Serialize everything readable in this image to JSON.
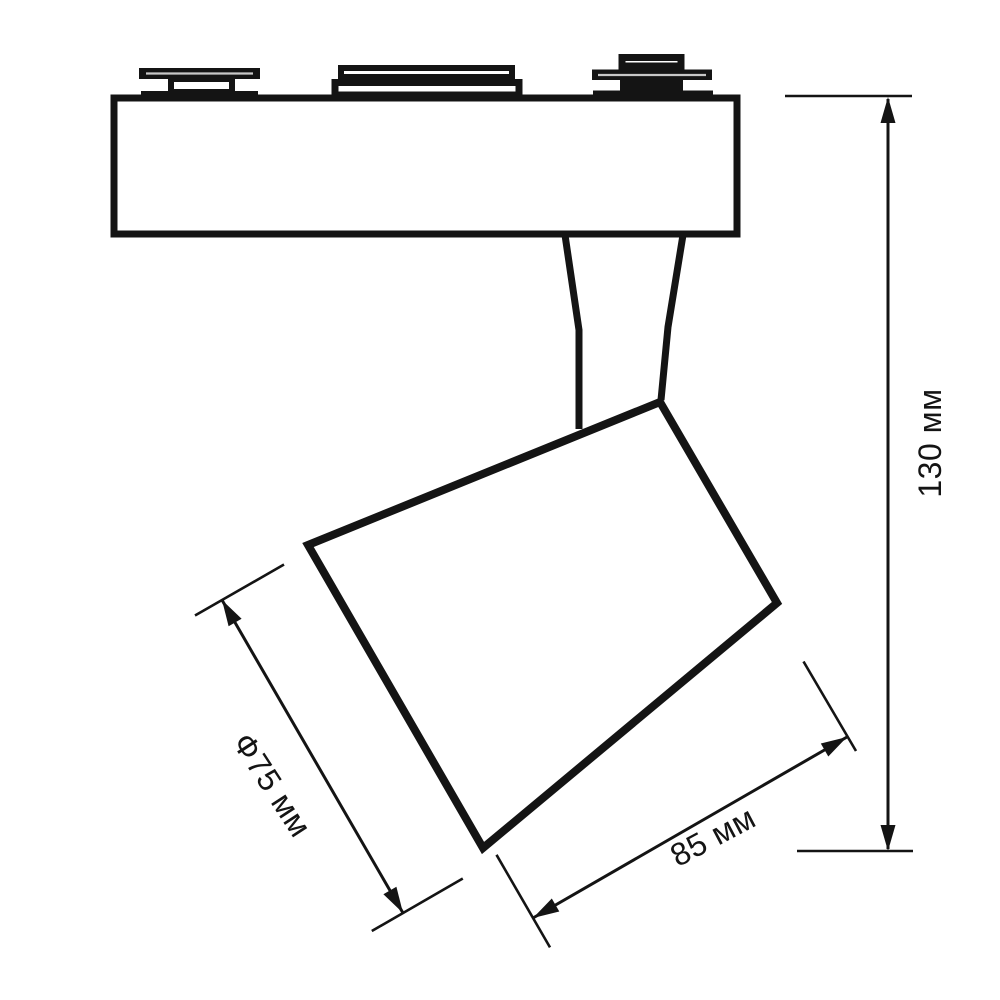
{
  "colors": {
    "line": "#141414",
    "background": "#ffffff",
    "slit": "#c8c8c8"
  },
  "dimensions": {
    "height": {
      "label": "130 мм",
      "value_mm": 130
    },
    "diameter": {
      "label": "Ф75 мм",
      "value_mm": 75
    },
    "width": {
      "label": "85 мм",
      "value_mm": 85
    }
  }
}
